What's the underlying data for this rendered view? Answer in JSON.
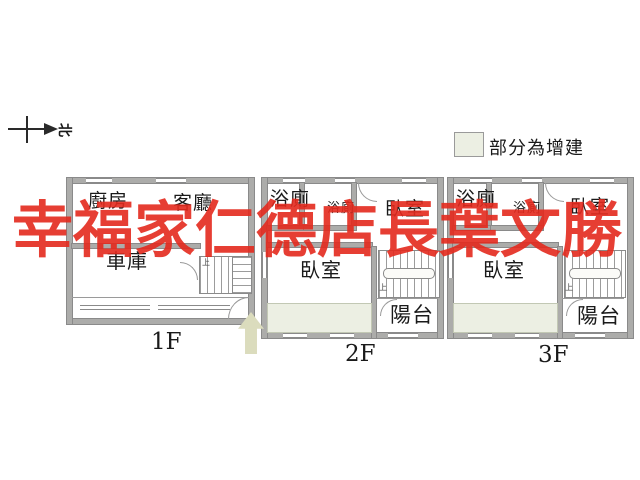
{
  "compass": {
    "north_label": "北"
  },
  "legend": {
    "label": "部分為增建"
  },
  "watermark": {
    "text": "幸福家仁德店長葉文勝"
  },
  "floors": {
    "f1": {
      "label": "1F",
      "kitchen": "廚房",
      "living_room": "客廳",
      "garage": "車庫",
      "stair_up": "上"
    },
    "f2": {
      "label": "2F",
      "bathroom": "浴廁",
      "bathroom_small": "浴廁",
      "bedroom_front": "臥室",
      "bedroom_main": "臥室",
      "balcony": "陽台",
      "stair_up": "上"
    },
    "f3": {
      "label": "3F",
      "bathroom": "浴廁",
      "bathroom_small": "浴廁",
      "bedroom_front": "臥室",
      "bedroom_main": "臥室",
      "balcony": "陽台",
      "stair_up": "上"
    }
  },
  "colors": {
    "watermark_red": "#e42a1e",
    "addition_green": "#ecefe3",
    "arrow_beige": "#dbdcbd",
    "wall_gray": "#acacaa"
  }
}
